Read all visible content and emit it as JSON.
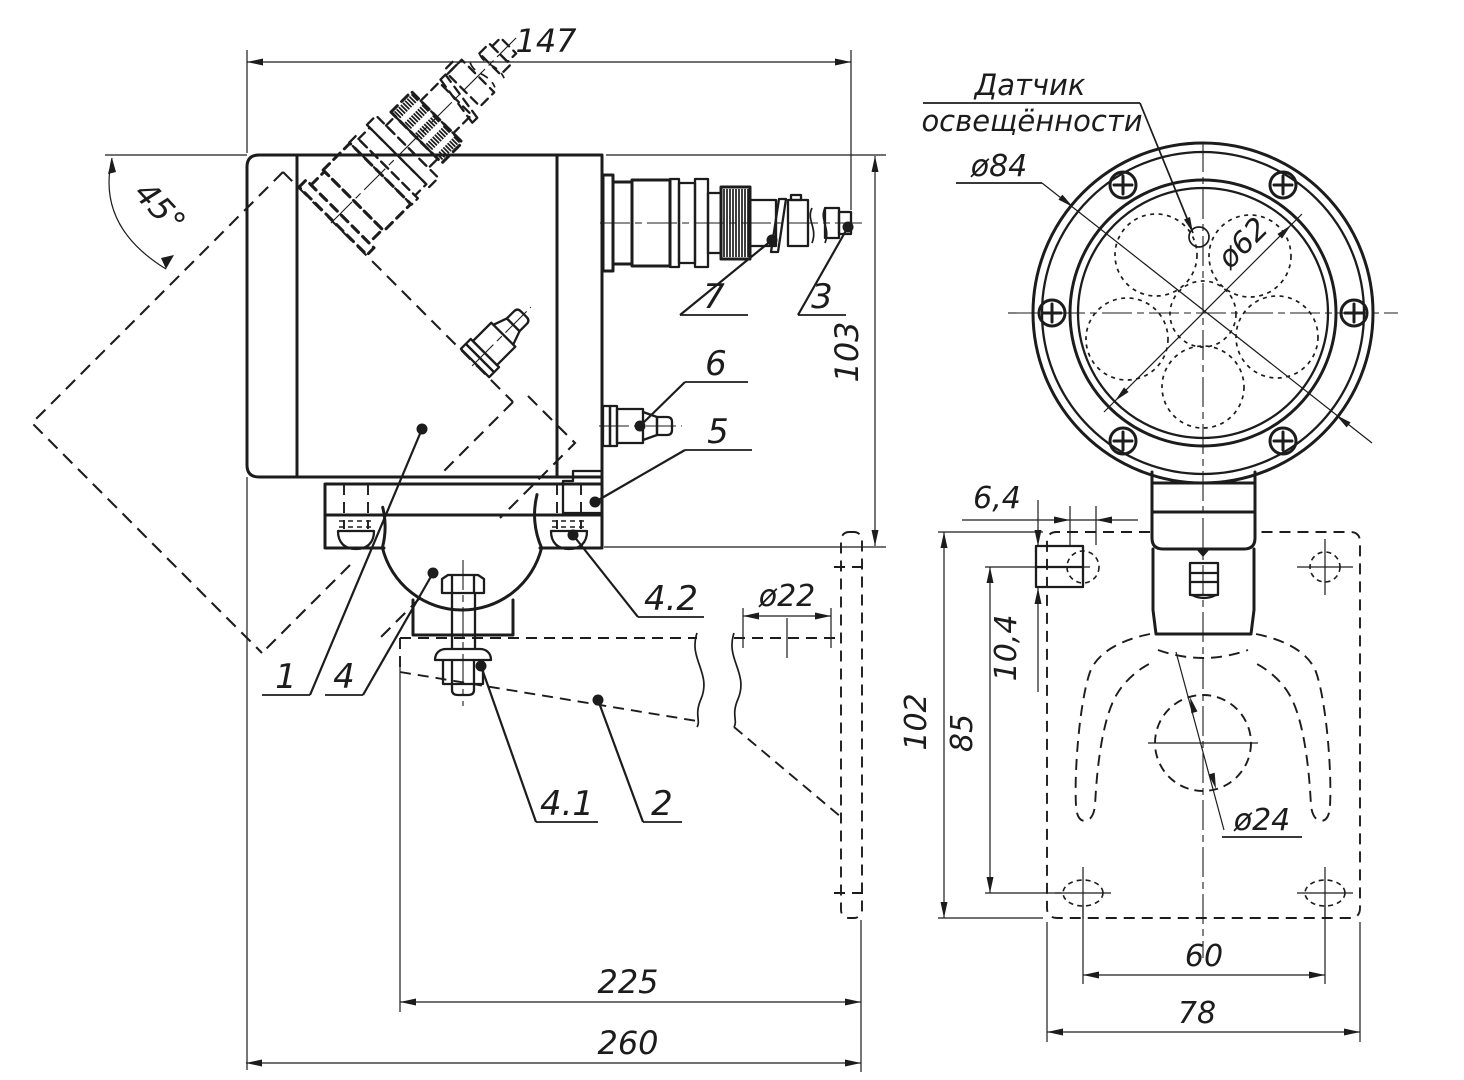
{
  "colors": {
    "ink": "#1c1c1c",
    "background": "#ffffff"
  },
  "views": {
    "side_view": {
      "dimensions": {
        "width": "147",
        "angle": "45°",
        "height": "103",
        "boss_diameter": "ø22",
        "arm_length": "225",
        "total_length": "260"
      },
      "callouts": {
        "body": "1",
        "bracket": "2",
        "pin": "3",
        "ball_joint": "4",
        "nut": "4.1",
        "clamp_screw": "4.2",
        "block": "5",
        "valve": "6",
        "connector": "7"
      }
    },
    "front_view": {
      "labels": {
        "sensor_line1": "Датчик",
        "sensor_line2": "освещённости"
      },
      "dimensions": {
        "face_diameter": "ø84",
        "glass_diameter": "ø62",
        "slot_width": "6,4",
        "boss_height": "10,4",
        "hole_span_vertical": "85",
        "plate_height": "102",
        "hole_span_horizontal": "60",
        "plate_width": "78",
        "claw_diameter": "ø24"
      }
    }
  }
}
